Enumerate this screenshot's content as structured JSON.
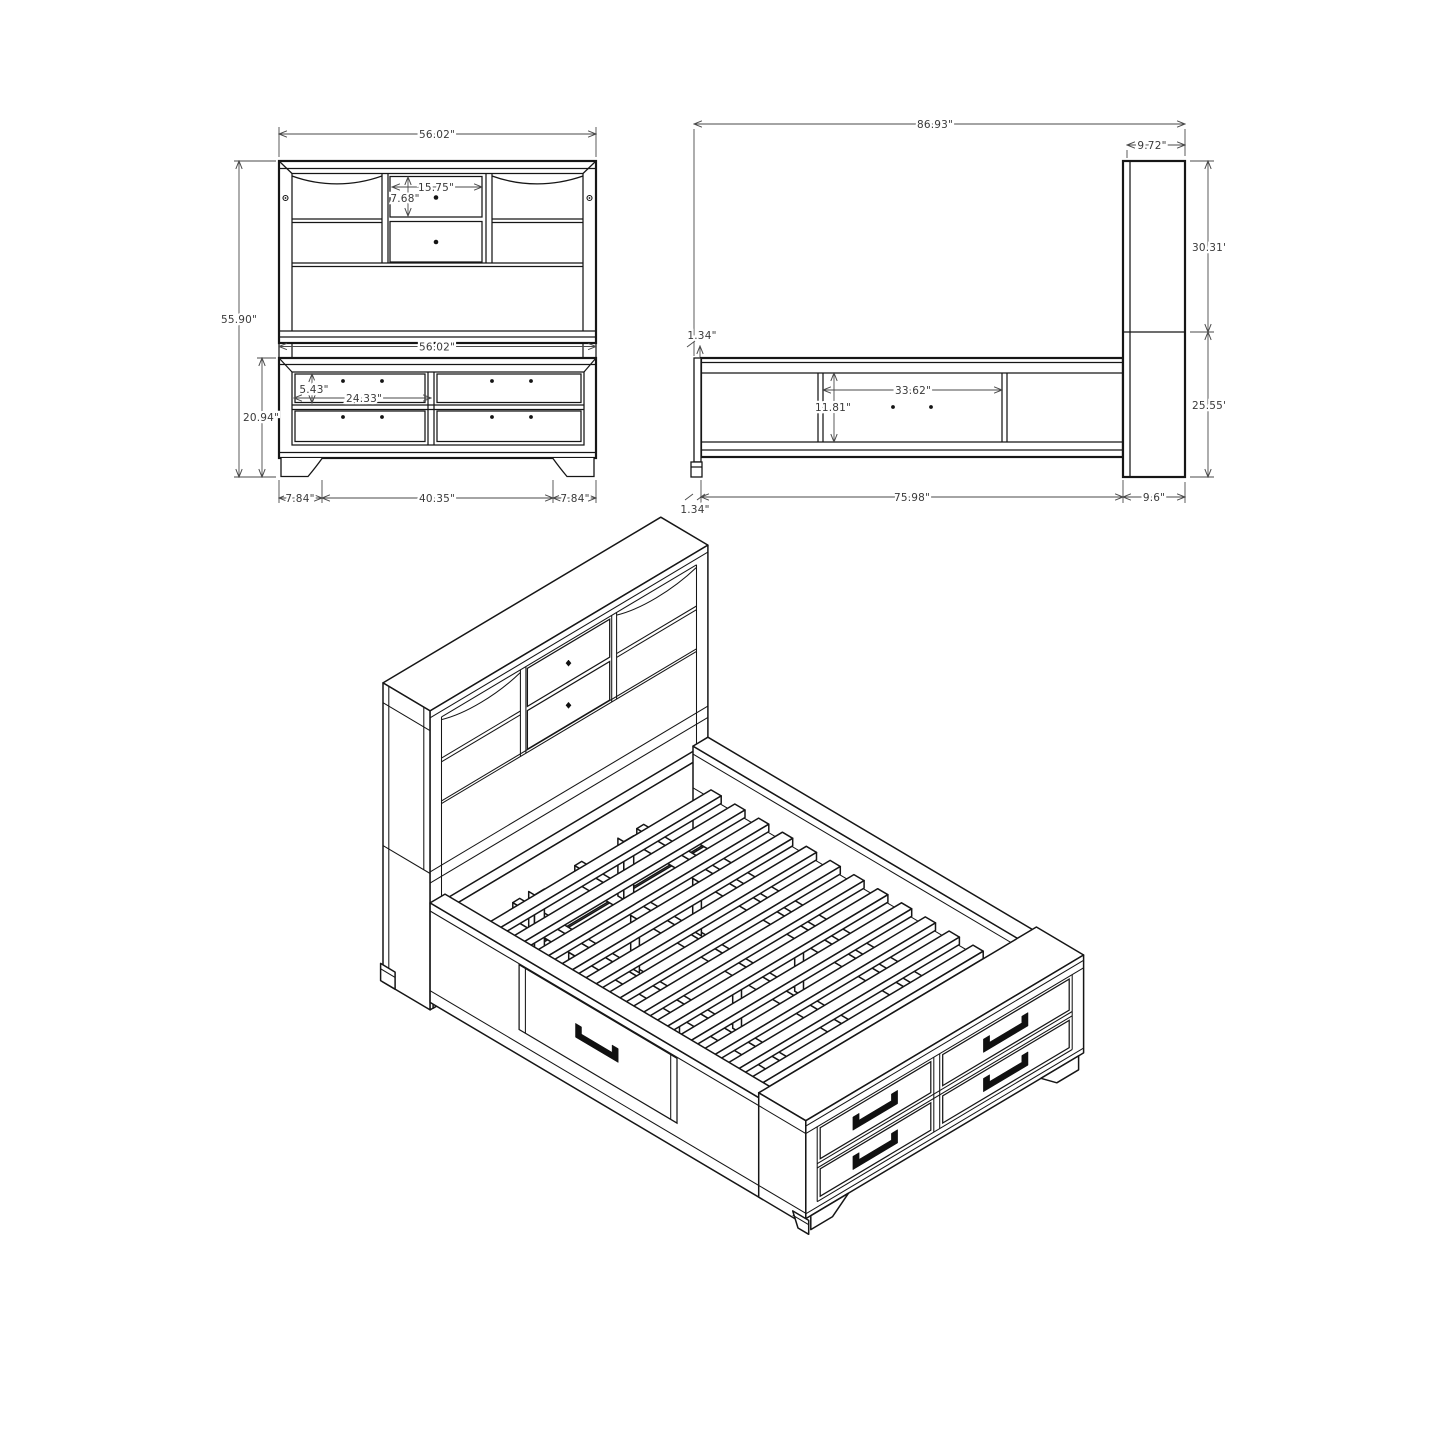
{
  "page": {
    "background": "#ffffff",
    "line_color": "#161616",
    "dimension_color": "#4a4a4a"
  },
  "views": {
    "front": {
      "dims": {
        "overall_width": "56.02\"",
        "shelf_width": "15.75\"",
        "shelf_height": "7.68\"",
        "overall_height": "55.90\"",
        "base_width": "56.02\"",
        "drawer_height": "5.43\"",
        "drawer_width": "24.33\"",
        "footboard_height": "20.94\"",
        "foot_offset_left": "7.84\"",
        "foot_span": "40.35\"",
        "foot_offset_right": "7.84\""
      }
    },
    "side": {
      "dims": {
        "overall_length": "86.93\"",
        "headboard_depth": "9.72\"",
        "headboard_upper_height": "30.31\"",
        "frame_lip_top": "1.34\"",
        "side_drawer_width": "33.62\"",
        "side_drawer_height": "11.81\"",
        "headboard_lower_height": "25.55\"",
        "rail_length": "75.98\"",
        "headboard_base_depth": "9.6\"",
        "frame_lip_bottom": "1.34\""
      }
    }
  }
}
